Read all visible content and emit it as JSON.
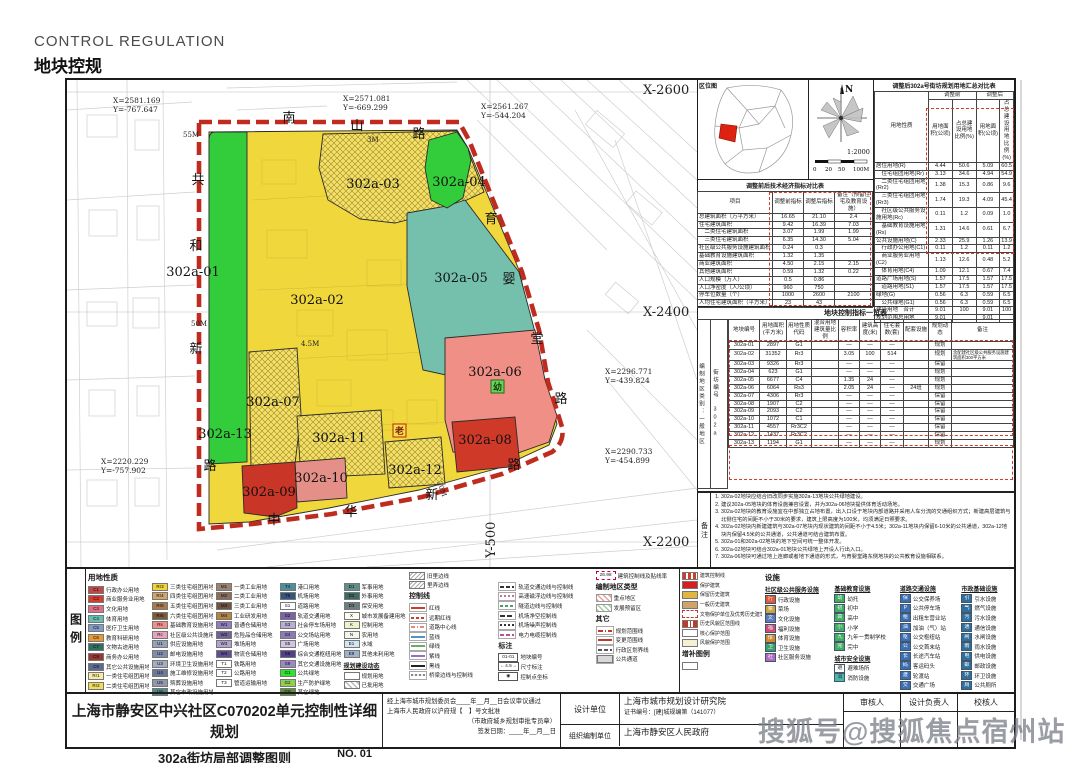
{
  "page": {
    "title_en": "CONTROL REGULATION",
    "title_zh": "地块控规",
    "watermark": "搜狐号@搜狐焦点宿州站"
  },
  "map": {
    "plots": [
      "302a-01",
      "302a-02",
      "302a-03",
      "302a-04",
      "302a-05",
      "302a-06",
      "302a-07",
      "302a-08",
      "302a-09",
      "302a-10",
      "302a-11",
      "302a-12",
      "302a-13"
    ],
    "roads": {
      "nanshan": "南山路",
      "gonghexin": "共和新路",
      "yuyingtang": "育婴堂路",
      "zhonghuaxin": "中华新路"
    },
    "grid": [
      "X-2600",
      "X-2400",
      "X-2200",
      "Y-500"
    ],
    "coords": [
      {
        "x": "X=2581.169",
        "y": "Y=-767.647"
      },
      {
        "x": "X=2571.081",
        "y": "Y=-669.299"
      },
      {
        "x": "X=2561.267",
        "y": "Y=-544.204"
      },
      {
        "x": "X=2296.771",
        "y": "Y=-439.824"
      },
      {
        "x": "X=2290.733",
        "y": "Y=-454.899"
      },
      {
        "x": "X=2220.229",
        "y": "Y=-757.902"
      }
    ],
    "widths": {
      "w55": "55M",
      "w50": "50M",
      "w20": "20M",
      "w45": "4.5M",
      "w3": "3M"
    },
    "markers": {
      "elder": "老",
      "kinder": "幼"
    }
  },
  "panel": {
    "locmap_label": "区位图",
    "north": "N",
    "scale": "1:2000",
    "scale_ticks": [
      "0",
      "20",
      "50",
      "100M"
    ],
    "eco": {
      "title": "调整前后技术经济指标对比表",
      "cols": [
        "项目",
        "调整前指标",
        "调整后指标",
        "备注（预留住宅及教育设施）"
      ],
      "rows": [
        [
          "总建筑面积（万平方米）",
          "16.65",
          "21.10",
          "2.4"
        ],
        [
          "住宅建筑面积",
          "9.42",
          "16.39",
          "7.03"
        ],
        [
          "　二类住宅建筑面积",
          "3.07",
          "1.99",
          "1.99"
        ],
        [
          "　三类住宅建筑面积",
          "6.35",
          "14.30",
          "5.04"
        ],
        [
          "社区级公共服务设施建筑面积",
          "0.24",
          "0.3",
          ""
        ],
        [
          "基础教育设施建筑面积",
          "1.32",
          "1.35",
          ""
        ],
        [
          "商业建筑面积",
          "4.50",
          "2.15",
          "2.15"
        ],
        [
          "其他建筑面积",
          "0.59",
          "1.32",
          "0.22"
        ],
        [
          "人口规模（万人）",
          "0.5",
          "0.86",
          ""
        ],
        [
          "人口净密度（人/公顷）",
          "960",
          "750",
          ""
        ],
        [
          "停车位数量（个）",
          "1000",
          "2600",
          "2100"
        ],
        [
          "人均住宅建筑面积（平方米）",
          "23",
          "43",
          ""
        ]
      ]
    },
    "summary": {
      "title": "调整后302a号街坊规划用地汇总对比表",
      "h1": [
        "用地性质",
        "调整前",
        "调整后"
      ],
      "h2": [
        "用地面积(公顷)",
        "占总建设用地比例(%)",
        "用地面积(公顷)",
        "占总建设用地比例(%)"
      ],
      "rows": [
        [
          "居住用地(R)",
          "4.44",
          "50.6",
          "5.09",
          "60.5"
        ],
        [
          "　住宅组团用地(Rr)",
          "3.13",
          "34.6",
          "4.94",
          "54.9"
        ],
        [
          "　二类住宅组团用地(Rr2)",
          "1.38",
          "15.3",
          "0.86",
          "9.6"
        ],
        [
          "　三类住宅组团用地(Rr3)",
          "1.74",
          "19.3",
          "4.09",
          "45.4"
        ],
        [
          "　社区级公共服务设施用地(Rc)",
          "0.11",
          "1.2",
          "0.09",
          "1.0"
        ],
        [
          "　基础教育设施用地(Rs)",
          "1.31",
          "14.6",
          "0.61",
          "6.7"
        ],
        [
          "公共设施用地(C)",
          "2.33",
          "25.9",
          "1.26",
          "13.9"
        ],
        [
          "　行政办公用地(C1)",
          "0.11",
          "1.2",
          "0.11",
          "1.2"
        ],
        [
          "　商业服务业用地(C2)",
          "1.13",
          "12.6",
          "0.48",
          "5.2"
        ],
        [
          "　体育用地(C4)",
          "1.09",
          "12.1",
          "0.67",
          "7.4"
        ],
        [
          "道路广场用地(S)",
          "1.57",
          "17.5",
          "1.57",
          "17.5"
        ],
        [
          "　道路用地(S1)",
          "1.57",
          "17.5",
          "1.57",
          "17.5"
        ],
        [
          "绿地(G)",
          "0.56",
          "6.3",
          "0.59",
          "6.5"
        ],
        [
          "　公共绿地(G1)",
          "0.56",
          "6.3",
          "0.59",
          "6.5"
        ],
        [
          "建设用地　合计",
          "9.01",
          "100",
          "9.01",
          "100"
        ],
        [
          "规划范围总用地",
          "9.01",
          "",
          "9.01",
          ""
        ]
      ]
    },
    "control": {
      "title": "地块控制指标一览表",
      "zone_label": "编制地区类别",
      "zone": "一般地区",
      "block_label": "街坊编号",
      "block": "302a",
      "cols": [
        "地块编号",
        "用地面积(平方米)",
        "用地性质代码",
        "混合用地建筑量比例",
        "容积率",
        "建筑高度(米)",
        "住宅套数(套)",
        "配套设施",
        "规划动态",
        "备注"
      ],
      "rows": [
        [
          "302a-01",
          "2897",
          "G1",
          "",
          "—",
          "—",
          "—",
          "",
          "规划",
          ""
        ],
        [
          "302a-02",
          "31352",
          "Rr3",
          "",
          "3.05",
          "100",
          "514",
          "",
          "规划",
          "含配建社区级公共服务设施建筑面积300平方米"
        ],
        [
          "302a-03",
          "9326",
          "Rr3",
          "",
          "—",
          "—",
          "—",
          "",
          "保留",
          ""
        ],
        [
          "302a-04",
          "623",
          "G1",
          "",
          "—",
          "—",
          "—",
          "",
          "规划",
          ""
        ],
        [
          "302a-05",
          "6677",
          "C4",
          "",
          "1.35",
          "24",
          "—",
          "",
          "规划",
          ""
        ],
        [
          "302a-06",
          "6064",
          "Rs3",
          "",
          "2.05",
          "24",
          "—",
          "24班",
          "规划",
          ""
        ],
        [
          "302a-07",
          "4306",
          "Rr3",
          "",
          "—",
          "—",
          "—",
          "",
          "保留",
          ""
        ],
        [
          "302a-08",
          "1907",
          "C2",
          "",
          "—",
          "—",
          "—",
          "",
          "保留",
          ""
        ],
        [
          "302a-09",
          "2093",
          "C2",
          "",
          "—",
          "—",
          "—",
          "",
          "保留",
          ""
        ],
        [
          "302a-10",
          "1072",
          "C1",
          "",
          "—",
          "—",
          "—",
          "",
          "保留",
          ""
        ],
        [
          "302a-11",
          "4557",
          "Rr3C2",
          "",
          "—",
          "—",
          "—",
          "",
          "保留",
          ""
        ],
        [
          "302a-12",
          "1437",
          "Rr3C2",
          "",
          "—",
          "—",
          "—",
          "",
          "保留",
          ""
        ],
        [
          "302a-13",
          "1194",
          "G1",
          "",
          "—",
          "—",
          "—",
          "",
          "规划",
          ""
        ]
      ]
    },
    "notes": {
      "label": "备注",
      "items": [
        "302a-02地块应结合旧改同步实施302a-13地块公共绿地建设。",
        "建议302a-05地块的体育设施兼容设置，并为302a-06地块提供体育活动场地。",
        "302a-02地块的教育设施宜在中部独立占地布置，出入口设于地块内部道路并采用人车分流的交通组织方式；新建高层建筑与北侧住宅的间距不小于30米的要求，建筑上限高度为100米，均须满足日照要求。",
        "302a-02地块内新建建筑与302a-07地块内现状建筑的间距不小于4.5米；302a-11地块内保留6-10米的公共通道，302a-12地块内保留4.5米的公共通道，公共通道可结合建筑布置。",
        "302a-01和302a-02地块的地下空间可统一整体开发。",
        "302a-02地块可结合302a-01地块公共绿地上开设人行出入口。",
        "302a-06地块可通过地上连廊或者地下通道的形式，与育婴堂路东侧地块的公共教育设施相联系。"
      ]
    }
  },
  "legend": {
    "label": "图例",
    "lu_title": "用地性质",
    "lu1": [
      {
        "t": "C1",
        "l": "行政办公用地",
        "c": "#c04a41"
      },
      {
        "t": "C2",
        "l": "商业服务业用地",
        "c": "#d23f30"
      },
      {
        "t": "C3",
        "l": "文化用地",
        "c": "#db7186"
      },
      {
        "t": "C4",
        "l": "体育用地",
        "c": "#66bfae"
      },
      {
        "t": "C5",
        "l": "医疗卫生用地",
        "c": "#7e9cc4"
      },
      {
        "t": "C6",
        "l": "教育科研用地",
        "c": "#e79a33"
      },
      {
        "t": "C7",
        "l": "文物古迹用地",
        "c": "#2f6f60"
      },
      {
        "t": "C8",
        "l": "商务办公用地",
        "c": "#973a31"
      },
      {
        "t": "C9",
        "l": "其它公共设施用地",
        "c": "#5b6c8e"
      },
      {
        "t": "Rr1",
        "l": "一类住宅组团用地",
        "c": "#f6eda2"
      },
      {
        "t": "Rr2",
        "l": "二类住宅组团用地",
        "c": "#f1dc55"
      }
    ],
    "lu2": [
      {
        "t": "Rr3",
        "l": "三类住宅组团用地",
        "c": "#f0d534"
      },
      {
        "t": "Rr4",
        "l": "四类住宅组团用地",
        "c": "#cfa866"
      },
      {
        "t": "Rr5",
        "l": "五类住宅组团用地",
        "c": "#a87c4d"
      },
      {
        "t": "Rr6",
        "l": "六类住宅组团用地",
        "c": "#7d5c39"
      },
      {
        "t": "Rs",
        "l": "基础教育设施用地",
        "c": "#ef9086"
      },
      {
        "t": "Rc",
        "l": "社区级公共设施用地",
        "c": "#e8a4b9"
      },
      {
        "t": "U1",
        "l": "供应设施用地",
        "c": "#93a3b8"
      },
      {
        "t": "U2",
        "l": "邮电设施用地",
        "c": "#7d90ab"
      },
      {
        "t": "U3",
        "l": "环境卫生设施用地",
        "c": "#a3aec2"
      },
      {
        "t": "U4",
        "l": "施工维修设施用地",
        "c": "#697b99"
      },
      {
        "t": "U5",
        "l": "殡葬设施用地",
        "c": "#8e9aab"
      },
      {
        "t": "U6",
        "l": "其它市政设施用地",
        "c": "#4e8d80"
      }
    ],
    "lu3": [
      {
        "t": "M1",
        "l": "一类工业用地",
        "c": "#9b8570"
      },
      {
        "t": "M2",
        "l": "二类工业用地",
        "c": "#8a6f56"
      },
      {
        "t": "M3",
        "l": "三类工业用地",
        "c": "#6f553f"
      },
      {
        "t": "M4",
        "l": "工业研发用地",
        "c": "#b5843f"
      },
      {
        "t": "W1",
        "l": "普通仓储用地",
        "c": "#8f80b8"
      },
      {
        "t": "W2",
        "l": "危险品仓储用地",
        "c": "#746198"
      },
      {
        "t": "W3",
        "l": "堆场用地",
        "c": "#b0a6cc"
      },
      {
        "t": "W4",
        "l": "物流仓储用地",
        "c": "#5e5090"
      },
      {
        "t": "T1",
        "l": "铁路用地",
        "c": "#ffffff"
      },
      {
        "t": "T2",
        "l": "公路用地",
        "c": "#ffffff"
      },
      {
        "t": "T3",
        "l": "管道运输用地",
        "c": "#ffffff"
      }
    ],
    "lu4": [
      {
        "t": "T4",
        "l": "港口用地",
        "c": "#4f8f99"
      },
      {
        "t": "T5",
        "l": "机场用地",
        "c": "#33567d"
      },
      {
        "t": "S1",
        "l": "道路用地",
        "c": "#ffffff"
      },
      {
        "t": "S2",
        "l": "轨道交通用地",
        "c": "#7a63a8"
      },
      {
        "t": "S3",
        "l": "社会停车场用地",
        "c": "#b9aed2"
      },
      {
        "t": "S4",
        "l": "公交场站用地",
        "c": "#8d7ab8"
      },
      {
        "t": "S5",
        "l": "广场用地",
        "c": "#cfc6e2"
      },
      {
        "t": "S6",
        "l": "综合交通枢纽用地",
        "c": "#52428a"
      },
      {
        "t": "S9",
        "l": "其它交通设施用地",
        "c": "#9a89c2"
      },
      {
        "t": "G1",
        "l": "公共绿地",
        "c": "#2ee52e"
      },
      {
        "t": "G2",
        "l": "生产防护绿地",
        "c": "#8fd14f"
      },
      {
        "t": "G9",
        "l": "其它绿地",
        "c": "#5a8f3c"
      }
    ],
    "lu5": [
      {
        "t": "D1",
        "l": "军事用地",
        "c": "#5f8f8a"
      },
      {
        "t": "D2",
        "l": "外事用地",
        "c": "#3d6b64"
      },
      {
        "t": "D3",
        "l": "保安用地",
        "c": "#6b7f7c"
      },
      {
        "t": "X",
        "l": "城市发展备建用地",
        "c": "#fdfdf0"
      },
      {
        "t": "K",
        "l": "控制用地",
        "c": "#eef3c8"
      },
      {
        "t": "N",
        "l": "农用地",
        "c": "#f2f7ea"
      },
      {
        "t": "E1",
        "l": "水域",
        "c": "#cfe8f4"
      },
      {
        "t": "E9",
        "l": "其他未利用地",
        "c": "#9fb3c8"
      }
    ],
    "dyn_title": "规划建设动态",
    "dyn": [
      {
        "cls": "bx",
        "l": "规划用地"
      },
      {
        "cls": "bx-hatch",
        "l": "已批用地"
      }
    ],
    "pre_ctrl": [
      {
        "cls": "bx-hatch2",
        "l": "旧里边线"
      },
      {
        "cls": "bx-hatch2",
        "l": "里弄边线"
      }
    ],
    "ctrl_title": "控制线",
    "ctrl1": [
      {
        "cls": "lnred",
        "l": "红线"
      },
      {
        "cls": "lnredd",
        "l": "远期红线"
      },
      {
        "cls": "lncen",
        "l": "道路中心线"
      },
      {
        "cls": "lnblue",
        "l": "蓝线"
      },
      {
        "cls": "lngreen",
        "l": "绿线"
      },
      {
        "cls": "lnpurp",
        "l": "紫线"
      },
      {
        "cls": "lnblack",
        "l": "黑线"
      },
      {
        "cls": "lnbridge",
        "l": "桥梁边线与控制线"
      }
    ],
    "ctrl2": [
      {
        "cls": "lnrail",
        "l": "轨道交通边线与控制线"
      },
      {
        "cls": "lnmag",
        "l": "高速磁浮边线与控制线"
      },
      {
        "cls": "lntun",
        "l": "隧道边线与控制线"
      },
      {
        "cls": "lnair1",
        "l": "机场净空控制线"
      },
      {
        "cls": "lnair2",
        "l": "机场噪声控制线"
      },
      {
        "cls": "lnpow",
        "l": "电力电缆控制线"
      }
    ],
    "marks_title": "标注",
    "marks": [
      {
        "sym": "01-01",
        "l": "地块编号"
      },
      {
        "sym": "←4.5→",
        "l": "尺寸标注"
      },
      {
        "sym": "◉",
        "l": "控制点坐标"
      }
    ],
    "bl_sym": "26.98",
    "bl_label": "建筑控制线及贴线率",
    "zone_title": "编制地区类型",
    "zones": [
      {
        "cls": "bx-hatchred",
        "l": "重点地区"
      },
      {
        "cls": "bx-hatchgreen",
        "l": "发展预留区"
      }
    ],
    "other_title": "其它",
    "others": [
      {
        "cls": "lnrdd",
        "l": "规划范围线"
      },
      {
        "cls": "lnred2",
        "l": "变更范围线"
      },
      {
        "cls": "lnadm",
        "l": "行政区划界线"
      },
      {
        "cls": "bx-gray",
        "l": "公共通道"
      }
    ],
    "heritage": [
      {
        "cls": "lnredd",
        "l": "建筑控制线"
      },
      {
        "cls": "sw",
        "c": "#d61f1f",
        "l": "保护建筑"
      },
      {
        "cls": "sw",
        "c": "#e0b63f",
        "l": "保留历史建筑"
      },
      {
        "cls": "sw",
        "c": "#cfa46a",
        "l": "一般历史建筑"
      },
      {
        "cls": "bx-dashred",
        "l": "文物保护单位及优秀历史建筑保护范围线"
      },
      {
        "cls": "lnrdd",
        "l": "历史风貌区范围线"
      },
      {
        "cls": "bx",
        "l": "核心保护范围"
      },
      {
        "cls": "sw",
        "c": "#f4f0d2",
        "l": "风貌保护范围"
      }
    ],
    "supp_title": "增补图例",
    "fac_title": "设施",
    "comm_title": "社区级公共服务设施",
    "comm": [
      {
        "c": "#e05a3a",
        "ch": "行",
        "l": "行政设施"
      },
      {
        "c": "#caa23a",
        "ch": "菜",
        "l": "菜场"
      },
      {
        "c": "#5a79c0",
        "ch": "文",
        "l": "文化设施"
      },
      {
        "c": "#d04a7a",
        "ch": "福",
        "l": "福利设施"
      },
      {
        "c": "#d08a2a",
        "ch": "体",
        "l": "体育设施"
      },
      {
        "c": "#3aa06a",
        "ch": "卫",
        "l": "卫生设施"
      },
      {
        "c": "#b06ac0",
        "ch": "社",
        "l": "社区服务设施"
      }
    ],
    "edu_title": "基础教育设施",
    "edu": [
      {
        "c": "#3fae62",
        "ch": "幼",
        "l": "幼托"
      },
      {
        "c": "#3fae62",
        "ch": "初",
        "l": "初中"
      },
      {
        "c": "#3fae62",
        "ch": "高",
        "l": "高中"
      },
      {
        "c": "#3fae62",
        "ch": "小",
        "l": "小学"
      },
      {
        "c": "#3fae62",
        "ch": "九",
        "l": "九年一贯制学校"
      },
      {
        "c": "#3fae62",
        "ch": "完",
        "l": "完中"
      }
    ],
    "safe_title": "城市安全设施",
    "safe": [
      {
        "c": "#ffffff",
        "ch": "避",
        "l": "避难场所"
      },
      {
        "c": "#4ab8b0",
        "ch": "消",
        "l": "消防设施"
      }
    ],
    "traffic_title": "道路交通设施",
    "traffic": [
      {
        "c": "#3b6fb5",
        "ch": "保",
        "l": "公交保养场"
      },
      {
        "c": "#3b6fb5",
        "ch": "P",
        "l": "公共停车场"
      },
      {
        "c": "#3b6fb5",
        "ch": "租",
        "l": "出租车营业站"
      },
      {
        "c": "#3b6fb5",
        "ch": "油",
        "l": "加油（气）站"
      },
      {
        "c": "#3b6fb5",
        "ch": "枢",
        "l": "公交枢纽站"
      },
      {
        "c": "#3b6fb5",
        "ch": "公",
        "l": "公交首末站"
      },
      {
        "c": "#3b6fb5",
        "ch": "长",
        "l": "长途汽车站"
      },
      {
        "c": "#3b6fb5",
        "ch": "码",
        "l": "客运码头"
      },
      {
        "c": "#3b6fb5",
        "ch": "渡",
        "l": "轮渡站"
      },
      {
        "c": "#3b6fb5",
        "ch": "交",
        "l": "交通广场"
      }
    ],
    "muni_title": "市政基础设施",
    "muni": [
      {
        "c": "#2f6fa0",
        "ch": "引",
        "l": "引水设施"
      },
      {
        "c": "#2f6fa0",
        "ch": "气",
        "l": "燃气设施"
      },
      {
        "c": "#2f6fa0",
        "ch": "污",
        "l": "污水设施"
      },
      {
        "c": "#2f6fa0",
        "ch": "通",
        "l": "通信设施"
      },
      {
        "c": "#2f6fa0",
        "ch": "闸",
        "l": "水闸设施"
      },
      {
        "c": "#2f6fa0",
        "ch": "雨",
        "l": "雨水设施"
      },
      {
        "c": "#2f6fa0",
        "ch": "电",
        "l": "供电设施"
      },
      {
        "c": "#2f6fa0",
        "ch": "邮",
        "l": "邮政设施"
      },
      {
        "c": "#2f6fa0",
        "ch": "环",
        "l": "环卫设施"
      },
      {
        "c": "#2f6fa0",
        "ch": "厕",
        "l": "公共厕所"
      }
    ]
  },
  "titleblock": {
    "main_title": "上海市静安区中兴社区C070202单元控制性详细规划",
    "sub_title": "302a街坊局部调整图则",
    "sheet_no": "NO. 01",
    "approve1": "经上海市城市规划委员会____年__月__日会议审议通过",
    "approve2": "上海市人民政府以沪府规【　】号文批准",
    "approve3": "（市政府城乡规划审批专员章）",
    "approve4": "签发日期：____年__月__日",
    "design_label": "设计单位",
    "design_value": "上海市城市规划设计研究院",
    "design_cert": "证书编号：[建]城规编第（141077）",
    "org_label": "组织编制单位",
    "org_value": "上海市静安区人民政府",
    "sign_cols": [
      "审核人",
      "设计负责人",
      "校核人"
    ]
  }
}
